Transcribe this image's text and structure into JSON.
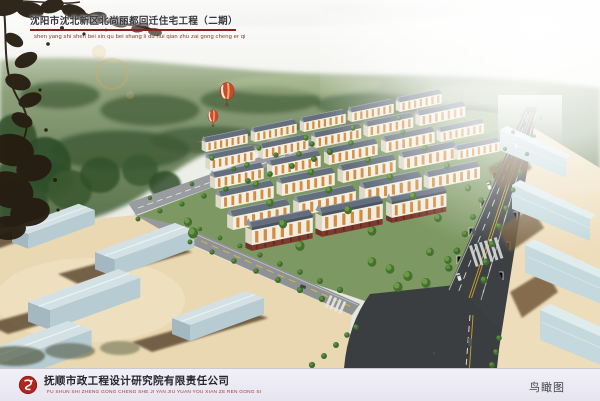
{
  "header": {
    "title": "沈阳市沈北新区北尚丽都回迁住宅工程（二期）",
    "pinyin": "shen yang shi shen bei xin qu bei shang li du hui qian zhu zai gong cheng er qi"
  },
  "footer": {
    "company_name": "抚顺市政工程设计研究院有限责任公司",
    "company_pinyin": "FU SHUN SHI ZHENG GONG CHENG SHE JI YAN JIU YUAN YOU XIAN ZE REN GONG SI",
    "view_label": "鸟瞰图"
  },
  "colors": {
    "title_underline": "#8b2020",
    "title_text": "#35353a",
    "pinyin_red": "#80362a",
    "logo_red": "#b3251f",
    "footer_bar_bg": "#edecf5",
    "road_asphalt": "#3c4043",
    "lane_marking_yellow": "#c9a52e",
    "building_wall_cream": "#f3efe2",
    "building_accent_orange": "#d28b40",
    "roof_gray": "#66707e",
    "commercial_base_red": "#7c3b2c",
    "warehouse_blue": "#bfd6da",
    "ground_tan": "#e9d8b2",
    "forest_green": "#5a744c",
    "balloon_red": "#c94836"
  }
}
